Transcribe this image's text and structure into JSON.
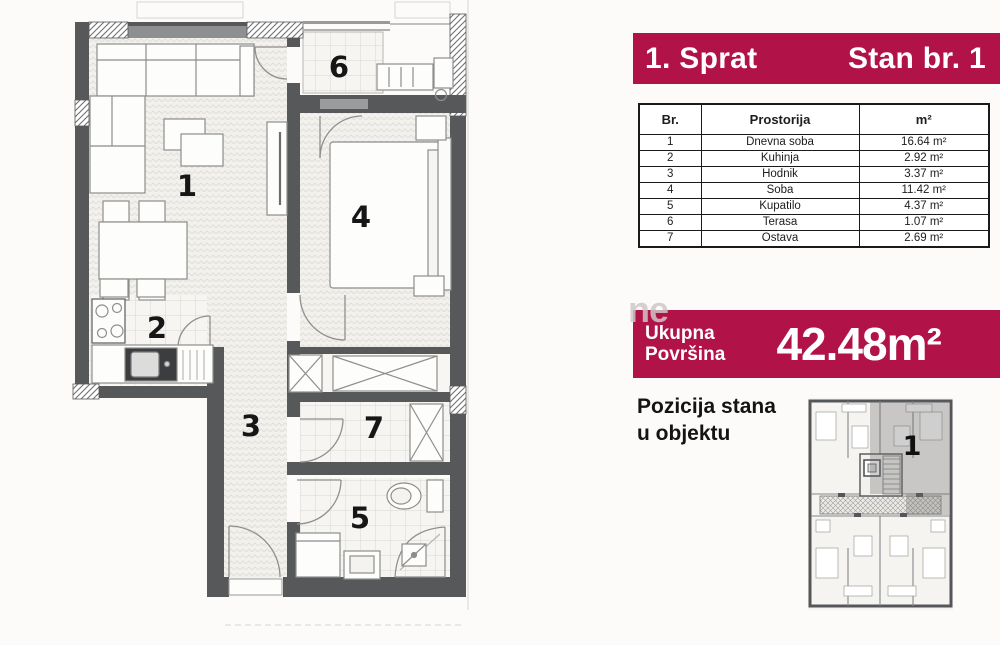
{
  "floor_plan": {
    "rooms": [
      {
        "id": "living-room",
        "number": "1"
      },
      {
        "id": "kitchen",
        "number": "2"
      },
      {
        "id": "hallway",
        "number": "3"
      },
      {
        "id": "bedroom",
        "number": "4"
      },
      {
        "id": "bathroom",
        "number": "5"
      },
      {
        "id": "terrace",
        "number": "6"
      },
      {
        "id": "storage",
        "number": "7"
      }
    ]
  },
  "panel": {
    "header": {
      "floor_label": "1. Sprat",
      "unit_label": "Stan br. 1"
    },
    "area_table": {
      "columns": [
        "Br.",
        "Prostorija",
        "m²"
      ],
      "rows": [
        {
          "br": "1",
          "prostorija": "Dnevna soba",
          "area": "16.64 m²"
        },
        {
          "br": "2",
          "prostorija": "Kuhinja",
          "area": "2.92 m²"
        },
        {
          "br": "3",
          "prostorija": "Hodnik",
          "area": "3.37 m²"
        },
        {
          "br": "4",
          "prostorija": "Soba",
          "area": "11.42 m²"
        },
        {
          "br": "5",
          "prostorija": "Kupatilo",
          "area": "4.37 m²"
        },
        {
          "br": "6",
          "prostorija": "Terasa",
          "area": "1.07 m²"
        },
        {
          "br": "7",
          "prostorija": "Ostava",
          "area": "2.69 m²"
        }
      ]
    },
    "total": {
      "label_line1": "Ukupna",
      "label_line2": "Površina",
      "value": "42.48m²"
    },
    "position": {
      "line1": "Pozicija stana",
      "line2": "u objektu",
      "unit_number": "1"
    }
  },
  "watermark": "ne",
  "colors": {
    "accent": "#b11348",
    "wall": "#57585a"
  }
}
